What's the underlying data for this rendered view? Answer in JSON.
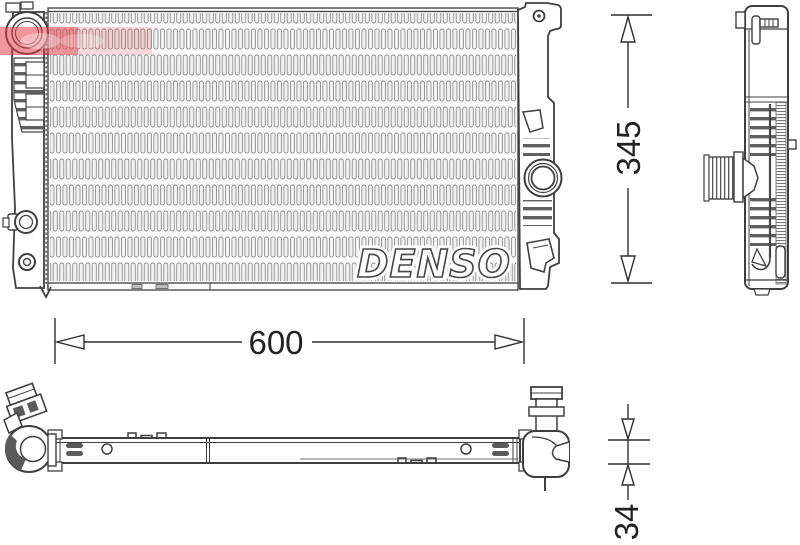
{
  "title": "Radiator technical drawing",
  "logo": {
    "text": "DENSO"
  },
  "dimensions": {
    "width": {
      "value": "600"
    },
    "height": {
      "value": "345"
    },
    "depth": {
      "value": "34"
    }
  },
  "colors": {
    "background": "#ffffff",
    "line": "#3f3f3f",
    "dimension_line": "#2f2f2f",
    "fin_gray": "#8e8e8e",
    "watermark_red": "#e23e48"
  },
  "views": {
    "front": "radiator-front-view",
    "side": "radiator-side-profile-view",
    "bottom": "radiator-bottom-view"
  }
}
